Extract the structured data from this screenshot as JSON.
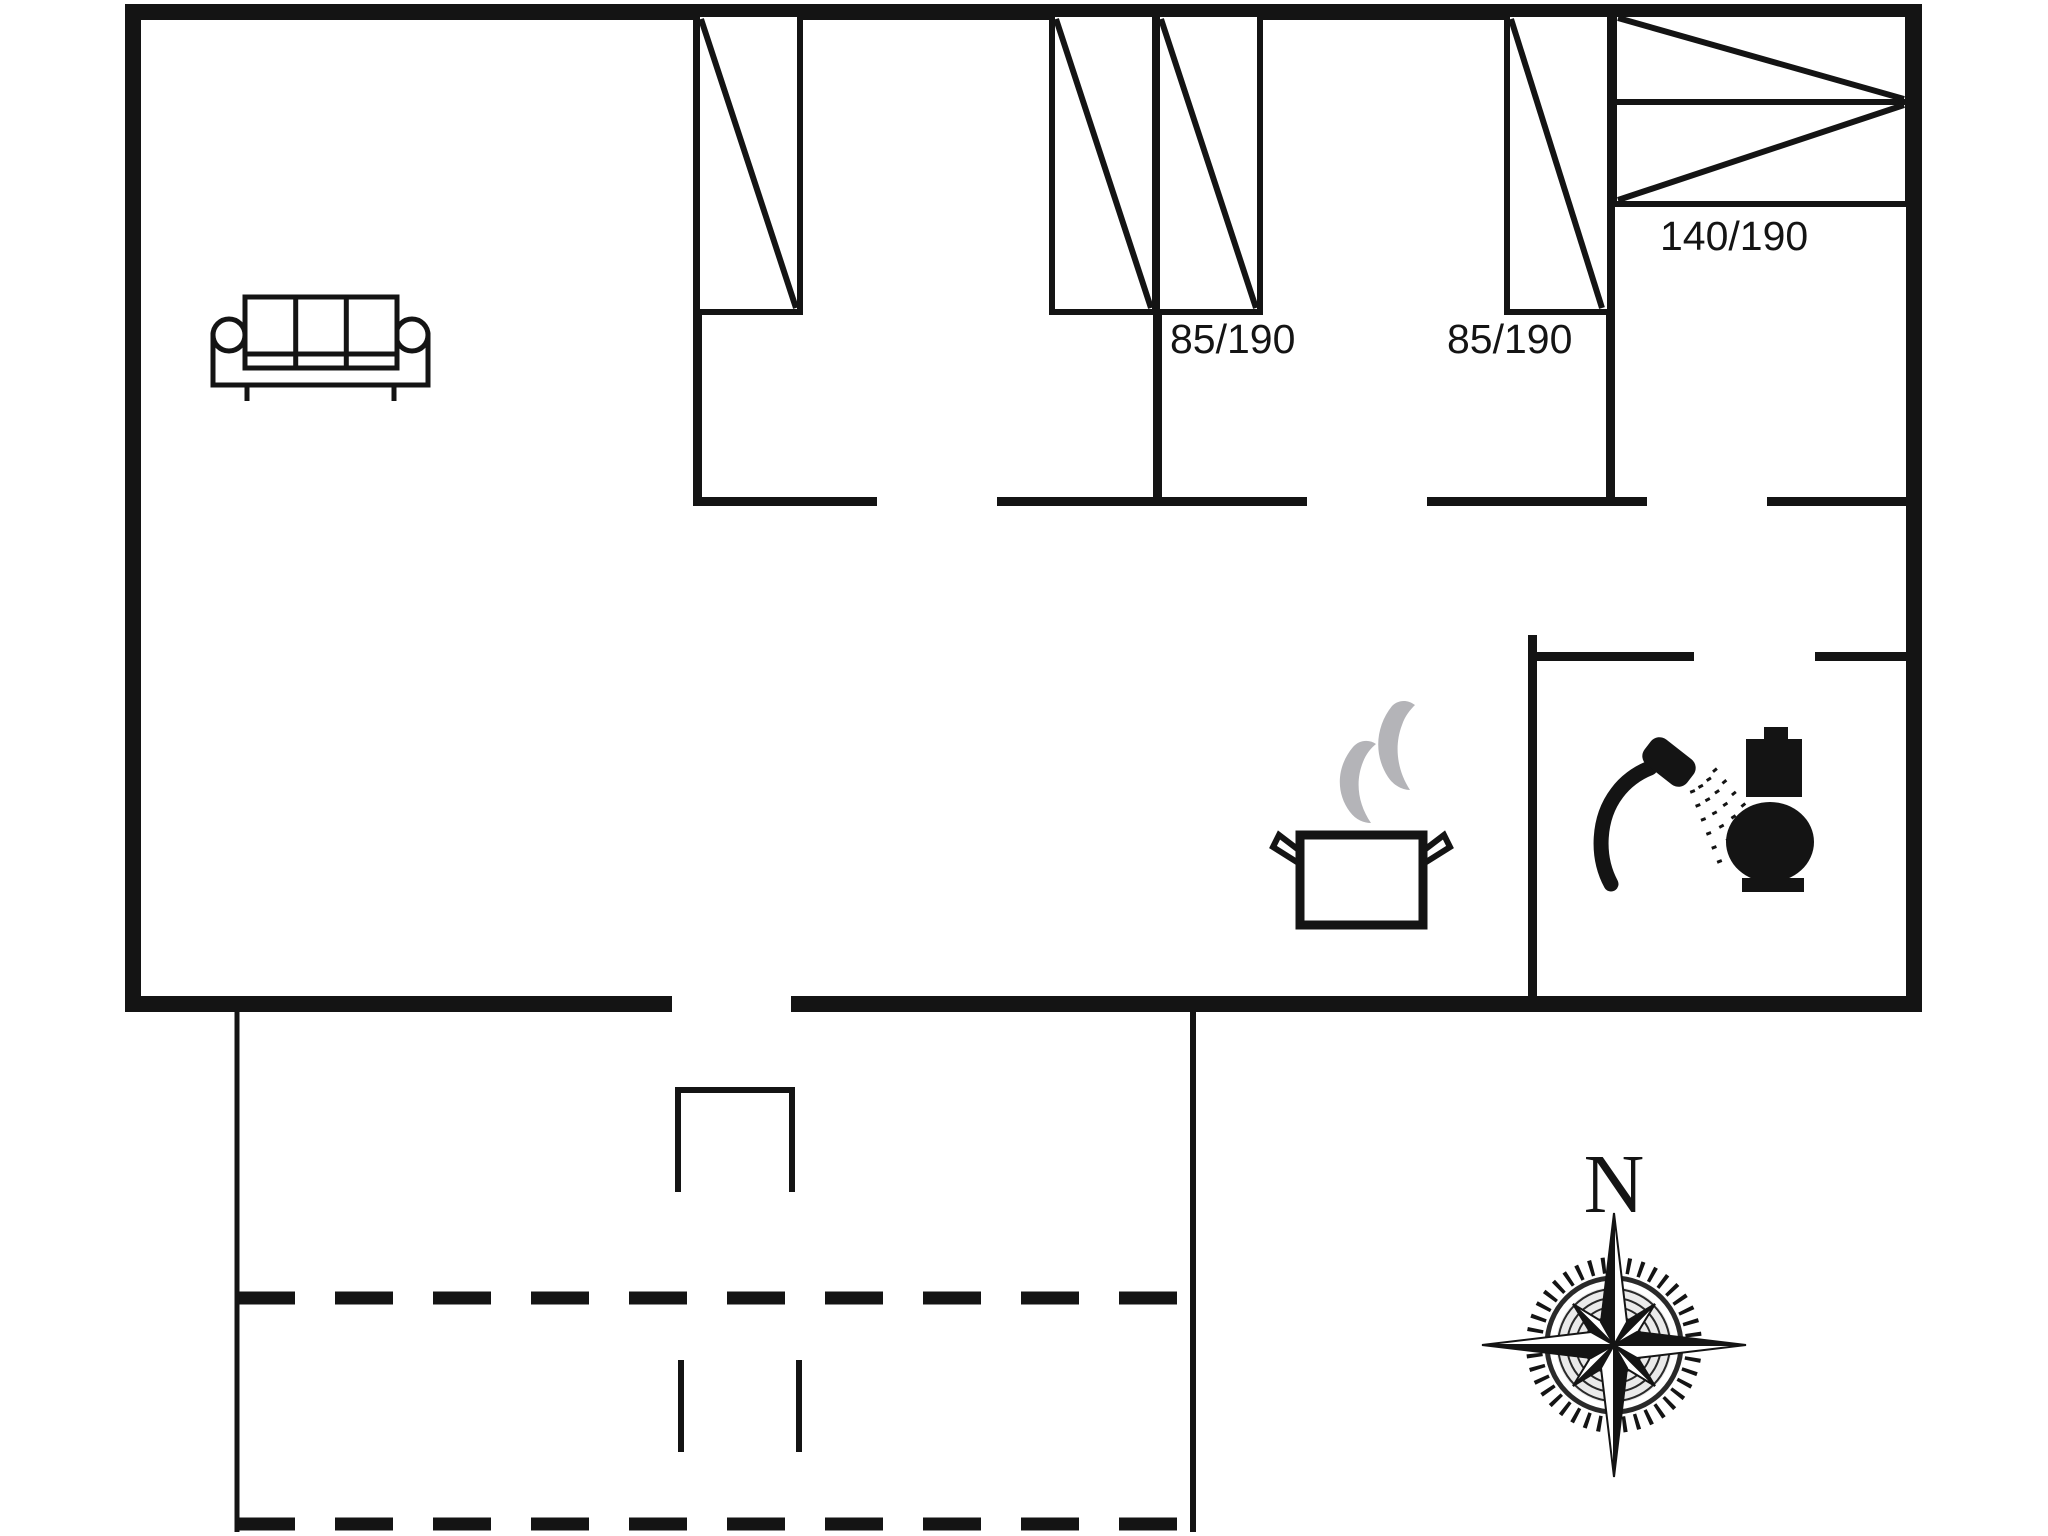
{
  "floor_plan": {
    "bed_size_labels": [
      {
        "text": "85/190"
      },
      {
        "text": "85/190"
      },
      {
        "text": "140/190"
      }
    ],
    "compass": {
      "north_label": "N"
    },
    "icons": [
      {
        "name": "sofa-icon"
      },
      {
        "name": "single-bed-icon"
      },
      {
        "name": "double-bed-icon"
      },
      {
        "name": "cooking-pot-icon"
      },
      {
        "name": "steam-icon"
      },
      {
        "name": "shower-icon"
      },
      {
        "name": "toilet-icon"
      },
      {
        "name": "compass-rose-icon"
      }
    ],
    "colors": {
      "line": "#141414",
      "steam": "#b4b4b8",
      "background": "#ffffff"
    }
  }
}
